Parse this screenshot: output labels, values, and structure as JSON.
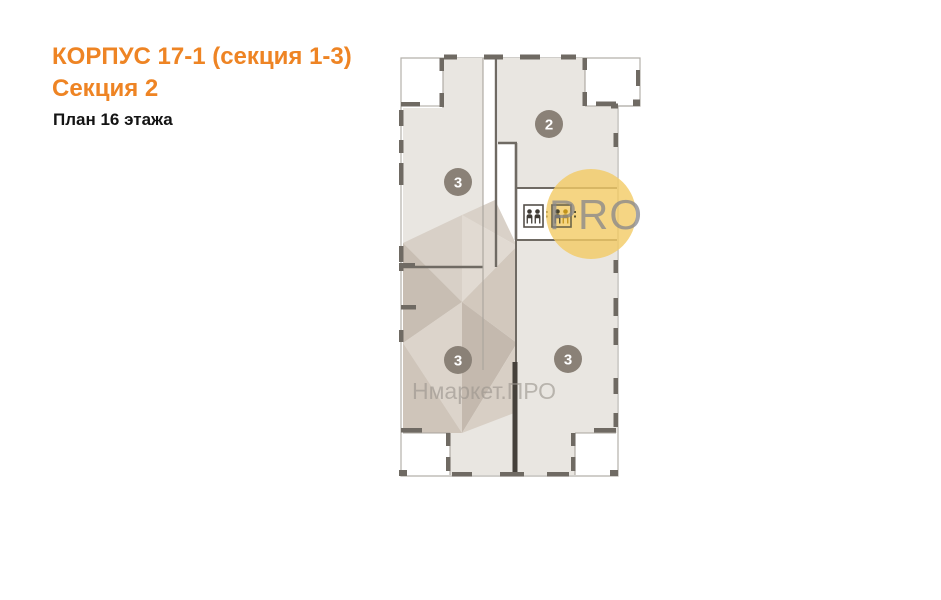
{
  "header": {
    "building": "КОРПУС 17-1 (секция 1-3)",
    "section": "Секция 2",
    "floor": "План 16 этажа"
  },
  "plan": {
    "units": [
      {
        "number": "2",
        "position": "top-right"
      },
      {
        "number": "3",
        "position": "top-left"
      },
      {
        "number": "3",
        "position": "bottom-left"
      },
      {
        "number": "3",
        "position": "bottom-right"
      }
    ],
    "icons": {
      "elevator_left": "elevator-icon",
      "elevator_right": "elevator-icon"
    }
  },
  "watermark": {
    "pro": "PRO",
    "brand": "Нмаркет.ПРО"
  },
  "colors": {
    "accent_orange": "#ee8424",
    "badge_gray": "#8a8177",
    "wall_dark": "#6f6a63",
    "apartment_fill": "#e9e6e1",
    "watermark_yellow": "#f3cb64"
  }
}
